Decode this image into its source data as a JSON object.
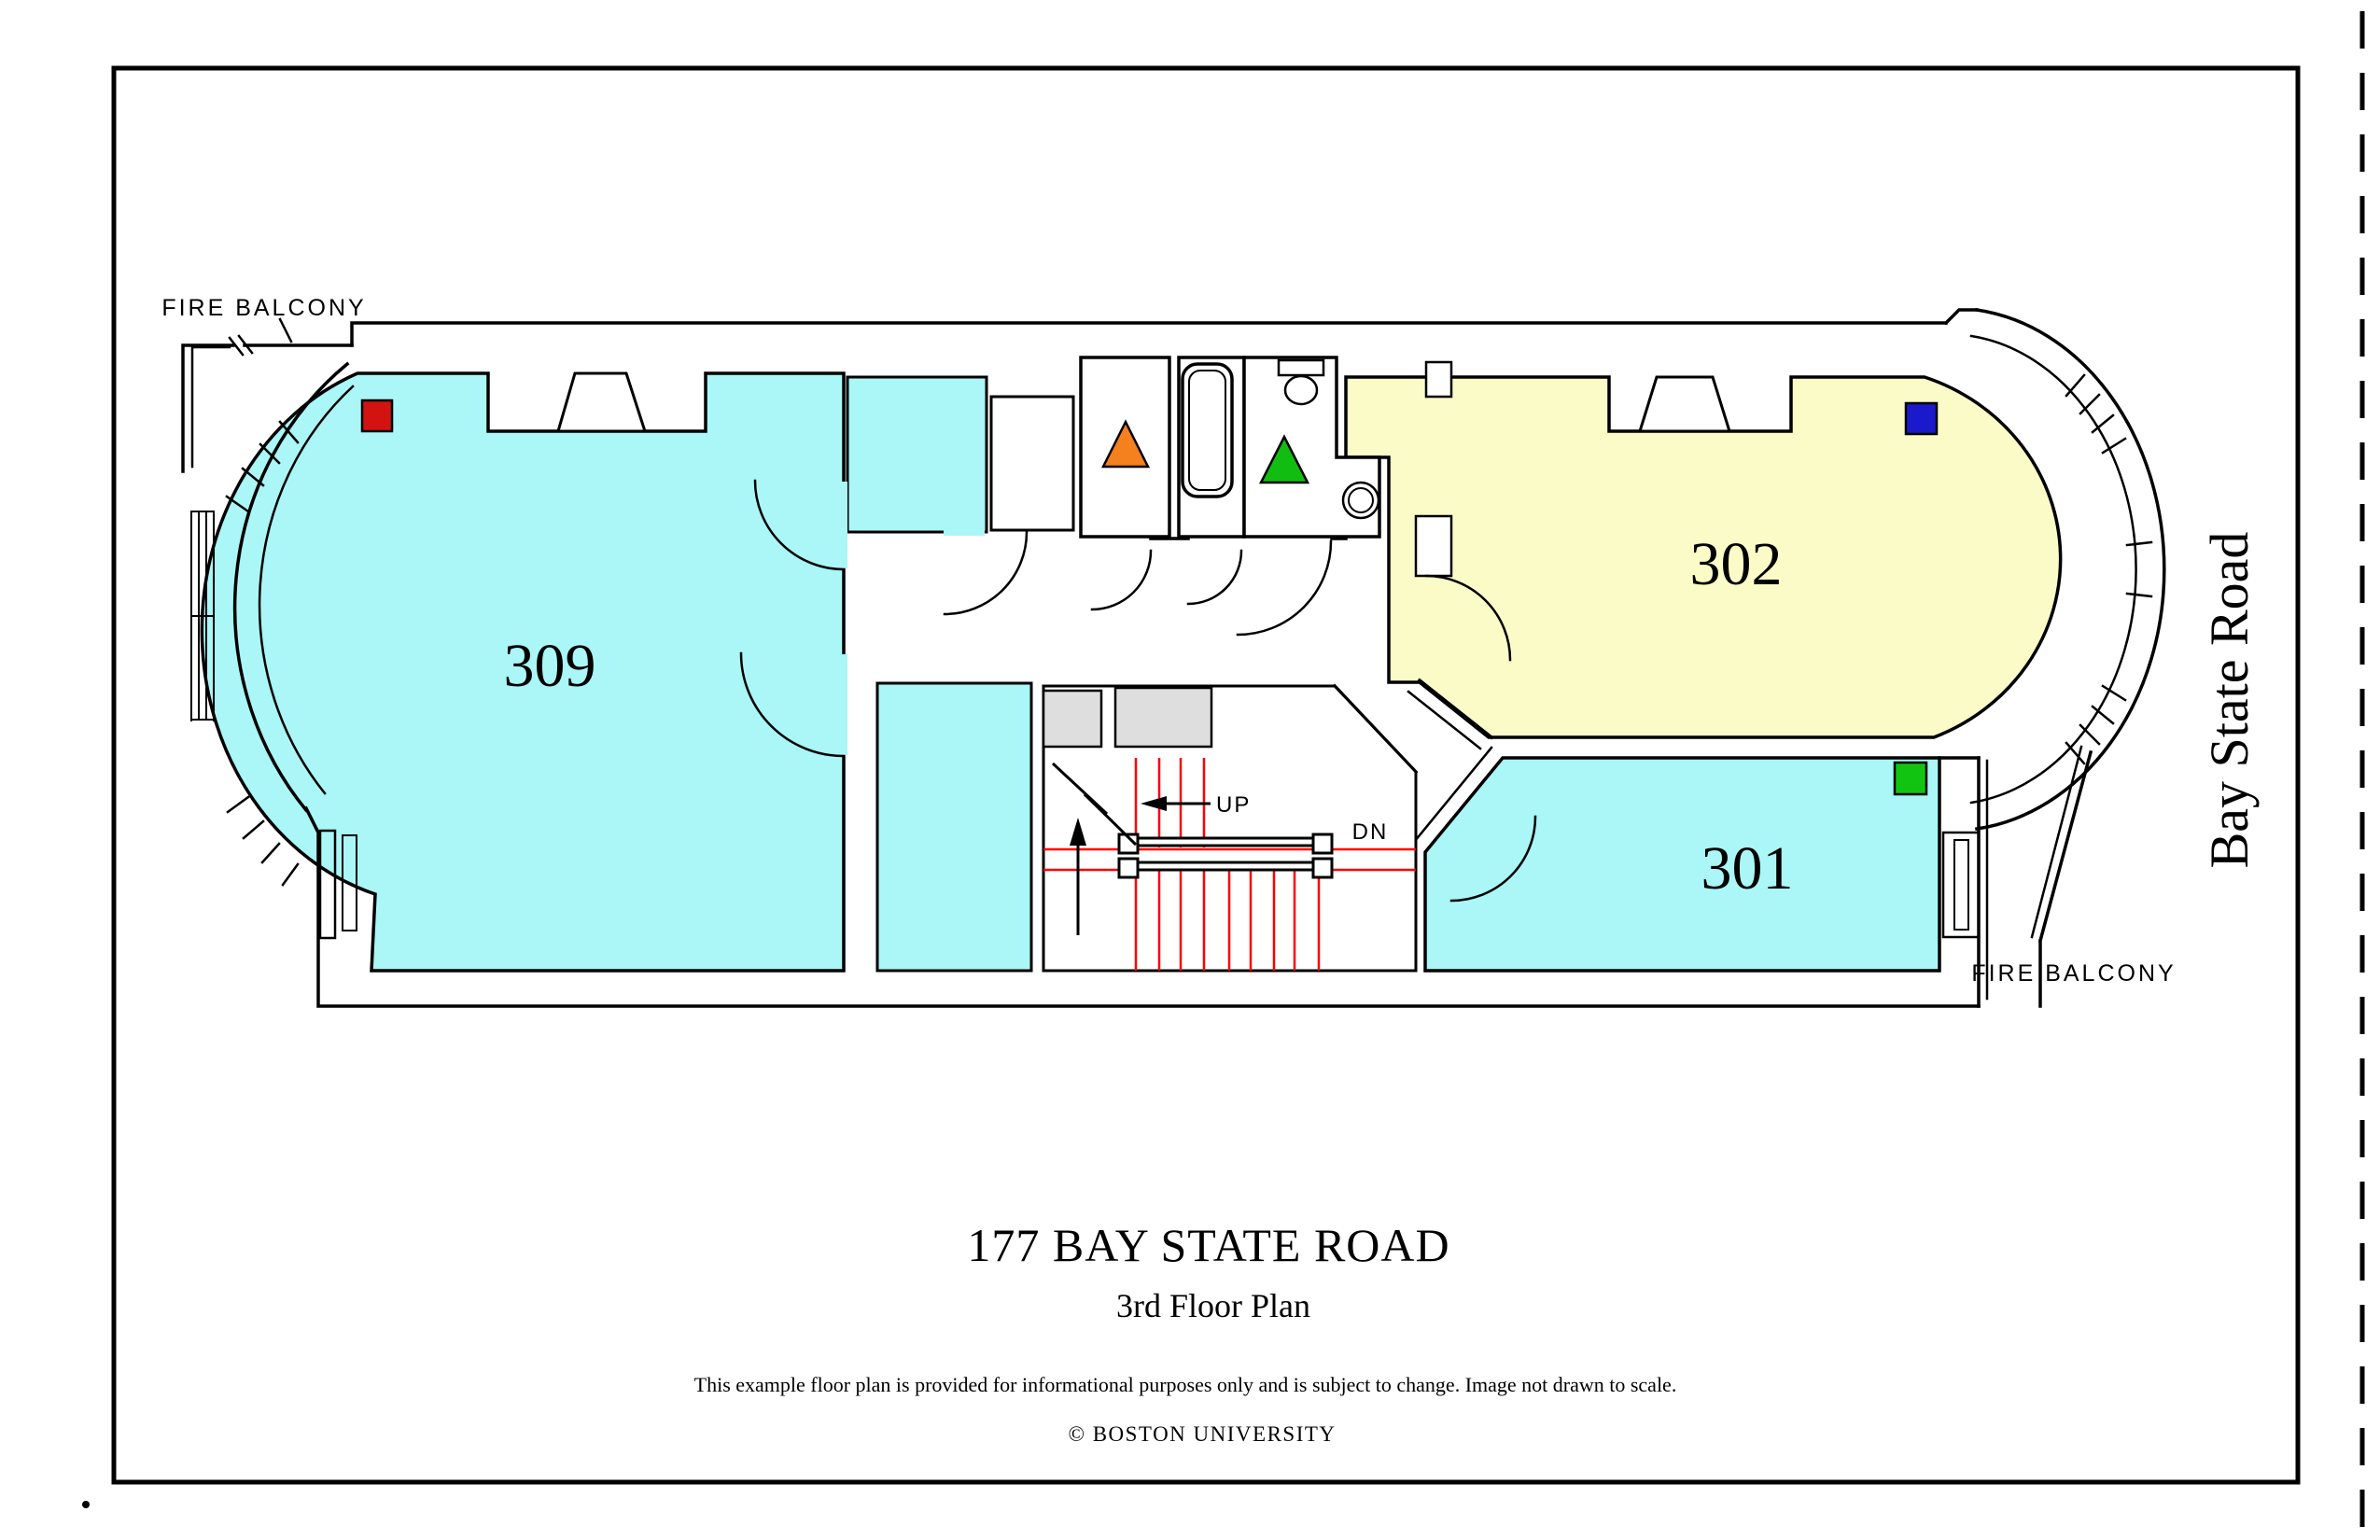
{
  "building": {
    "title": "177 BAY STATE ROAD",
    "subtitle": "3rd Floor Plan",
    "disclaimer": "This example floor plan is provided for informational purposes only and is subject to change. Image not drawn to scale.",
    "copyright": "© BOSTON UNIVERSITY",
    "street_name": "Bay State Road"
  },
  "labels": {
    "fire_balcony_top": "FIRE BALCONY",
    "fire_balcony_bottom": "FIRE BALCONY",
    "stairs_up": "UP",
    "stairs_down": "DN"
  },
  "rooms": [
    {
      "number": "309",
      "fill": "#ABF6F6",
      "type": "room-cyan"
    },
    {
      "number": "302",
      "fill": "#FBFBC8",
      "type": "room-yellow"
    },
    {
      "number": "301",
      "fill": "#ABF6F6",
      "type": "room-cyan"
    }
  ],
  "markers": [
    {
      "shape": "square",
      "color": "#D31212",
      "location": "room-309-northwest"
    },
    {
      "shape": "triangle",
      "color": "#F5801E",
      "location": "closet-center"
    },
    {
      "shape": "triangle",
      "color": "#12BD12",
      "location": "bathroom-center"
    },
    {
      "shape": "square",
      "color": "#1A1ACC",
      "location": "room-302-northwest"
    },
    {
      "shape": "square",
      "color": "#12C412",
      "location": "room-301-northeast"
    }
  ],
  "colors": {
    "wall": "#000000",
    "stair_tread": "#FF0000",
    "shaft_gray": "#DEDEDE",
    "room_cyan": "#ABF6F6",
    "room_yellow": "#FBFBC8",
    "background": "#FFFFFF"
  }
}
